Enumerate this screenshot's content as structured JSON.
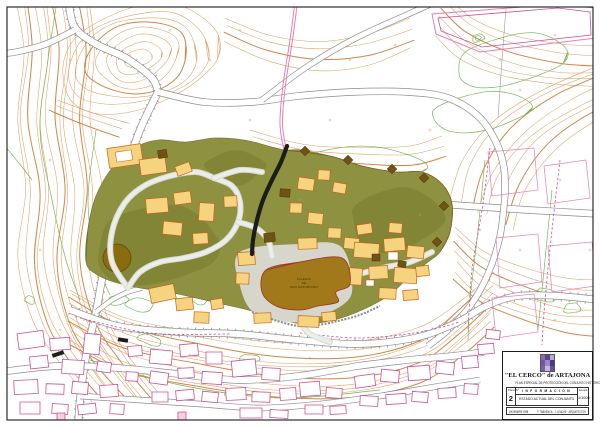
{
  "title_block": {
    "title": "\"EL CERCO\" de ARTAJONA",
    "subtitle": "PLAN ESPECIAL DE PROTECCIÓN DEL CONJUNTO HISTÓRICO",
    "sheet_label": "Plano Nº",
    "sheet_number": "2",
    "section_header": "I N F O R M A C I Ó N",
    "sheet_name": "ESTADO ACTUAL DEL CONJUNTO",
    "scale_label": "Escala",
    "scale_value": "1/1000",
    "date": "DICIEMBRE 1998",
    "credit": "F. TABUENCA · J. LEACHE · ARQUITECTOS"
  },
  "map_labels": {
    "church_line1": "IGLESIA",
    "church_line2": "DE",
    "church_line3": "SAN SATURNINO"
  },
  "colors": {
    "contour_orange": "#E09A5C",
    "contour_orange_dark": "#D07F3C",
    "vegetation_green": "#6FB54E",
    "parcel_pink": "#E87FB4",
    "parcel_pink_dark": "#D14F90",
    "plateau_olive": "#8E9140",
    "plateau_olive_dark": "#787B2E",
    "building_yellow": "#F6D37E",
    "building_outline_orange": "#C4641E",
    "church_brown": "#A1791A",
    "tower_brown": "#6F5214",
    "road_gray": "#8C8C8C",
    "wall_black": "#1C1C1C",
    "path_gray": "#D9D9D4",
    "plaza_gray": "#DCDCD8",
    "cross_tan": "#C89A6A",
    "deposit_brown": "#8A6C0E",
    "logo_purples": [
      "#8a6bb0",
      "#5d4390",
      "#b9a6d6",
      "#6f58a0",
      "#9d86c4",
      "#4e3a7e",
      "#7b5ea7",
      "#c9b8dc",
      "#66509a"
    ]
  }
}
